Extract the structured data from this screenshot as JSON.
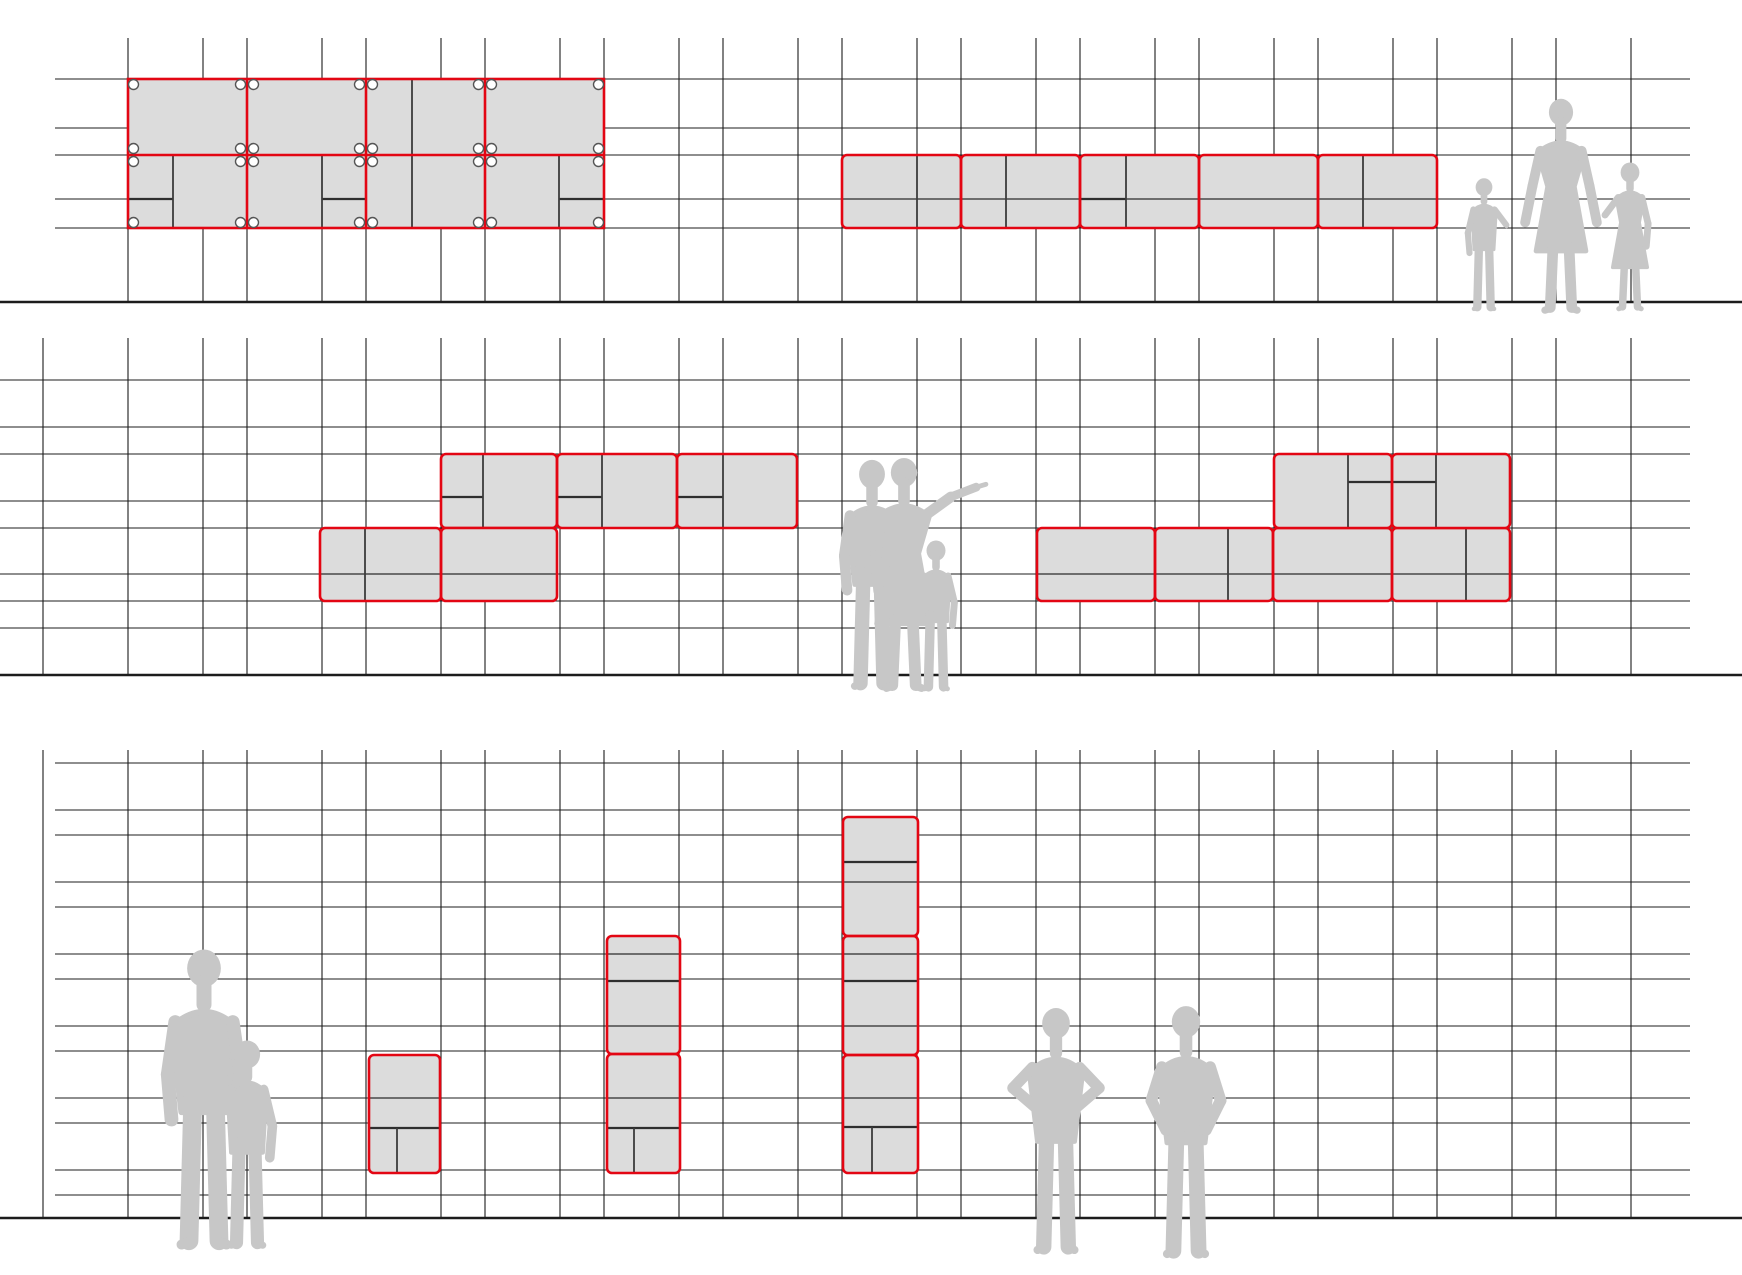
{
  "canvas": {
    "width": 1742,
    "height": 1275
  },
  "colors": {
    "background": "#ffffff",
    "red": "#e30613",
    "block_fill": "#dcdcdc",
    "grid_line": "#1c1c1c",
    "divider": "#3c3c3c",
    "through_line": "#2b2b2b",
    "shelf": "#2f2f2f",
    "silhouette": "#c7c7c7",
    "ball_stroke": "#555555",
    "ball_fill": "#ffffff"
  },
  "columns": [
    43,
    128,
    203,
    247,
    322,
    366,
    441,
    485,
    560,
    604,
    679,
    723,
    798,
    842,
    917,
    961,
    1036,
    1080,
    1155,
    1199,
    1274,
    1318,
    1393,
    1437,
    1512,
    1556,
    1631
  ],
  "bands": [
    {
      "id": "upper",
      "rows": [
        79,
        128,
        155,
        199,
        228
      ],
      "row_x": [
        55,
        1690
      ],
      "col_y": [
        38,
        302
      ],
      "skip_cols": [
        43
      ],
      "ground": {
        "y": 302,
        "x": [
          0,
          1742
        ]
      }
    },
    {
      "id": "middle",
      "rows": [
        380,
        427,
        454,
        501,
        528,
        574,
        601,
        628
      ],
      "row_x": [
        0,
        1690
      ],
      "col_y": [
        338,
        675
      ],
      "skip_cols": [],
      "ground": {
        "y": 675,
        "x": [
          0,
          1742
        ]
      }
    },
    {
      "id": "lower",
      "rows": [
        763,
        810,
        835,
        882,
        907,
        954,
        979,
        1026,
        1051,
        1098,
        1123,
        1170,
        1195
      ],
      "row_x": [
        55,
        1690
      ],
      "col_y": [
        750,
        1218
      ],
      "skip_cols": [],
      "ground": {
        "y": 1218,
        "x": [
          0,
          1742
        ]
      }
    }
  ],
  "assemblies": [
    {
      "id": "cabinet-ball-system",
      "band": "upper",
      "system": "ball",
      "outline": {
        "x": 128,
        "y": 79,
        "w": 476,
        "h": 149,
        "red_v": [
          247,
          366,
          485
        ],
        "red_h": [
          155
        ]
      },
      "nodes_x": [
        128,
        247,
        366,
        485,
        604
      ],
      "nodes_y": [
        79,
        155,
        228
      ],
      "dividers": [
        [
          173,
          155,
          173,
          228
        ],
        [
          322,
          155,
          322,
          228
        ],
        [
          412,
          79,
          412,
          155
        ],
        [
          412,
          155,
          412,
          228
        ],
        [
          559,
          155,
          559,
          228
        ]
      ],
      "shelves": [
        [
          128,
          199,
          173
        ],
        [
          322,
          199,
          366
        ],
        [
          559,
          199,
          604
        ]
      ],
      "through": []
    },
    {
      "id": "sideboard-rounded",
      "band": "upper",
      "system": "rounded",
      "modules": [
        [
          842,
          155,
          119,
          73
        ],
        [
          961,
          155,
          119,
          73
        ],
        [
          1080,
          155,
          119,
          73
        ],
        [
          1199,
          155,
          119,
          73
        ],
        [
          1318,
          155,
          119,
          73
        ]
      ],
      "dividers": [
        [
          917,
          155,
          917,
          228
        ],
        [
          1006,
          155,
          1006,
          228
        ],
        [
          1126,
          155,
          1126,
          228
        ],
        [
          1363,
          155,
          1363,
          228
        ]
      ],
      "shelves": [
        [
          1080,
          199,
          1126
        ]
      ],
      "through": [
        [
          842,
          199,
          1437,
          199
        ]
      ]
    },
    {
      "id": "mid-left-upper-row",
      "band": "middle",
      "system": "rounded",
      "modules": [
        [
          441,
          454,
          116,
          74
        ],
        [
          557,
          454,
          120,
          74
        ],
        [
          677,
          454,
          120,
          74
        ]
      ],
      "dividers": [
        [
          483,
          454,
          483,
          528
        ],
        [
          602,
          454,
          602,
          528
        ],
        [
          723,
          454,
          723,
          528
        ],
        [
          483,
          528,
          483,
          601
        ]
      ],
      "shelves": [
        [
          441,
          497,
          483
        ],
        [
          557,
          497,
          602
        ],
        [
          677,
          497,
          723
        ]
      ],
      "through": []
    },
    {
      "id": "mid-left-lower-row",
      "band": "middle",
      "system": "rounded",
      "modules": [
        [
          320,
          528,
          121,
          73
        ],
        [
          441,
          528,
          116,
          73
        ]
      ],
      "dividers": [
        [
          365,
          528,
          365,
          601
        ]
      ],
      "shelves": [],
      "through": [
        [
          320,
          574,
          557,
          574
        ]
      ]
    },
    {
      "id": "mid-right-lower-row",
      "band": "middle",
      "system": "rounded",
      "modules": [
        [
          1037,
          528,
          118,
          73
        ],
        [
          1155,
          528,
          118,
          73
        ],
        [
          1273,
          528,
          119,
          73
        ],
        [
          1392,
          528,
          118,
          73
        ]
      ],
      "dividers": [
        [
          1228,
          528,
          1228,
          601
        ],
        [
          1466,
          528,
          1466,
          601
        ]
      ],
      "shelves": [],
      "through": [
        [
          1037,
          574,
          1510,
          574
        ]
      ]
    },
    {
      "id": "mid-right-upper-row",
      "band": "middle",
      "system": "rounded",
      "modules": [
        [
          1274,
          454,
          118,
          74
        ],
        [
          1392,
          454,
          118,
          74
        ]
      ],
      "dividers": [
        [
          1348,
          454,
          1348,
          528
        ],
        [
          1436,
          454,
          1436,
          528
        ]
      ],
      "shelves": [
        [
          1348,
          482,
          1436
        ]
      ],
      "through": []
    },
    {
      "id": "tower-one",
      "band": "lower",
      "system": "rounded",
      "modules": [
        [
          369,
          1055,
          71,
          118
        ]
      ],
      "dividers": [
        [
          397,
          1128,
          397,
          1173
        ]
      ],
      "shelves": [
        [
          369,
          1128,
          440
        ]
      ],
      "through": [
        [
          369,
          1098,
          440,
          1098
        ]
      ]
    },
    {
      "id": "tower-two",
      "band": "lower",
      "system": "rounded",
      "modules": [
        [
          607,
          936,
          73,
          118
        ],
        [
          607,
          1054,
          73,
          119
        ]
      ],
      "dividers": [
        [
          634,
          1128,
          634,
          1173
        ]
      ],
      "shelves": [
        [
          607,
          981,
          680
        ],
        [
          607,
          1128,
          680
        ]
      ],
      "through": [
        [
          607,
          954,
          680,
          954
        ],
        [
          607,
          1026,
          680,
          1026
        ],
        [
          607,
          1098,
          680,
          1098
        ]
      ]
    },
    {
      "id": "tower-three",
      "band": "lower",
      "system": "rounded",
      "modules": [
        [
          843,
          817,
          75,
          119
        ],
        [
          843,
          936,
          75,
          119
        ],
        [
          843,
          1055,
          75,
          118
        ]
      ],
      "dividers": [
        [
          872,
          1127,
          872,
          1173
        ]
      ],
      "shelves": [
        [
          843,
          862,
          918
        ],
        [
          843,
          981,
          918
        ],
        [
          843,
          1127,
          918
        ]
      ],
      "through": [
        [
          843,
          882,
          918,
          882
        ],
        [
          843,
          954,
          918,
          954
        ],
        [
          843,
          1026,
          918,
          1026
        ],
        [
          843,
          1098,
          918,
          1098
        ]
      ]
    }
  ],
  "silhouettes": [
    {
      "id": "family-group",
      "figures": [
        {
          "variant": "child",
          "cx": 1484,
          "ground": 310,
          "h": 134,
          "reach": "right"
        },
        {
          "variant": "woman",
          "cx": 1561,
          "ground": 312,
          "h": 215
        },
        {
          "variant": "girl",
          "cx": 1630,
          "ground": 310,
          "h": 150,
          "reach": "left"
        }
      ]
    },
    {
      "id": "pointing-group",
      "figures": [
        {
          "variant": "man",
          "cx": 872,
          "ground": 688,
          "h": 230
        },
        {
          "variant": "woman-point",
          "cx": 904,
          "ground": 690,
          "h": 234
        },
        {
          "variant": "child",
          "cx": 936,
          "ground": 690,
          "h": 152,
          "reach": "left"
        }
      ]
    },
    {
      "id": "father-child-group",
      "figures": [
        {
          "variant": "man",
          "cx": 204,
          "ground": 1247,
          "h": 300
        },
        {
          "variant": "child",
          "cx": 247,
          "ground": 1247,
          "h": 210,
          "reach": "left"
        }
      ]
    },
    {
      "id": "observers-group",
      "figures": [
        {
          "variant": "man-hips",
          "cx": 1056,
          "ground": 1252,
          "h": 246
        },
        {
          "variant": "man-pockets",
          "cx": 1186,
          "ground": 1256,
          "h": 252
        }
      ]
    }
  ]
}
